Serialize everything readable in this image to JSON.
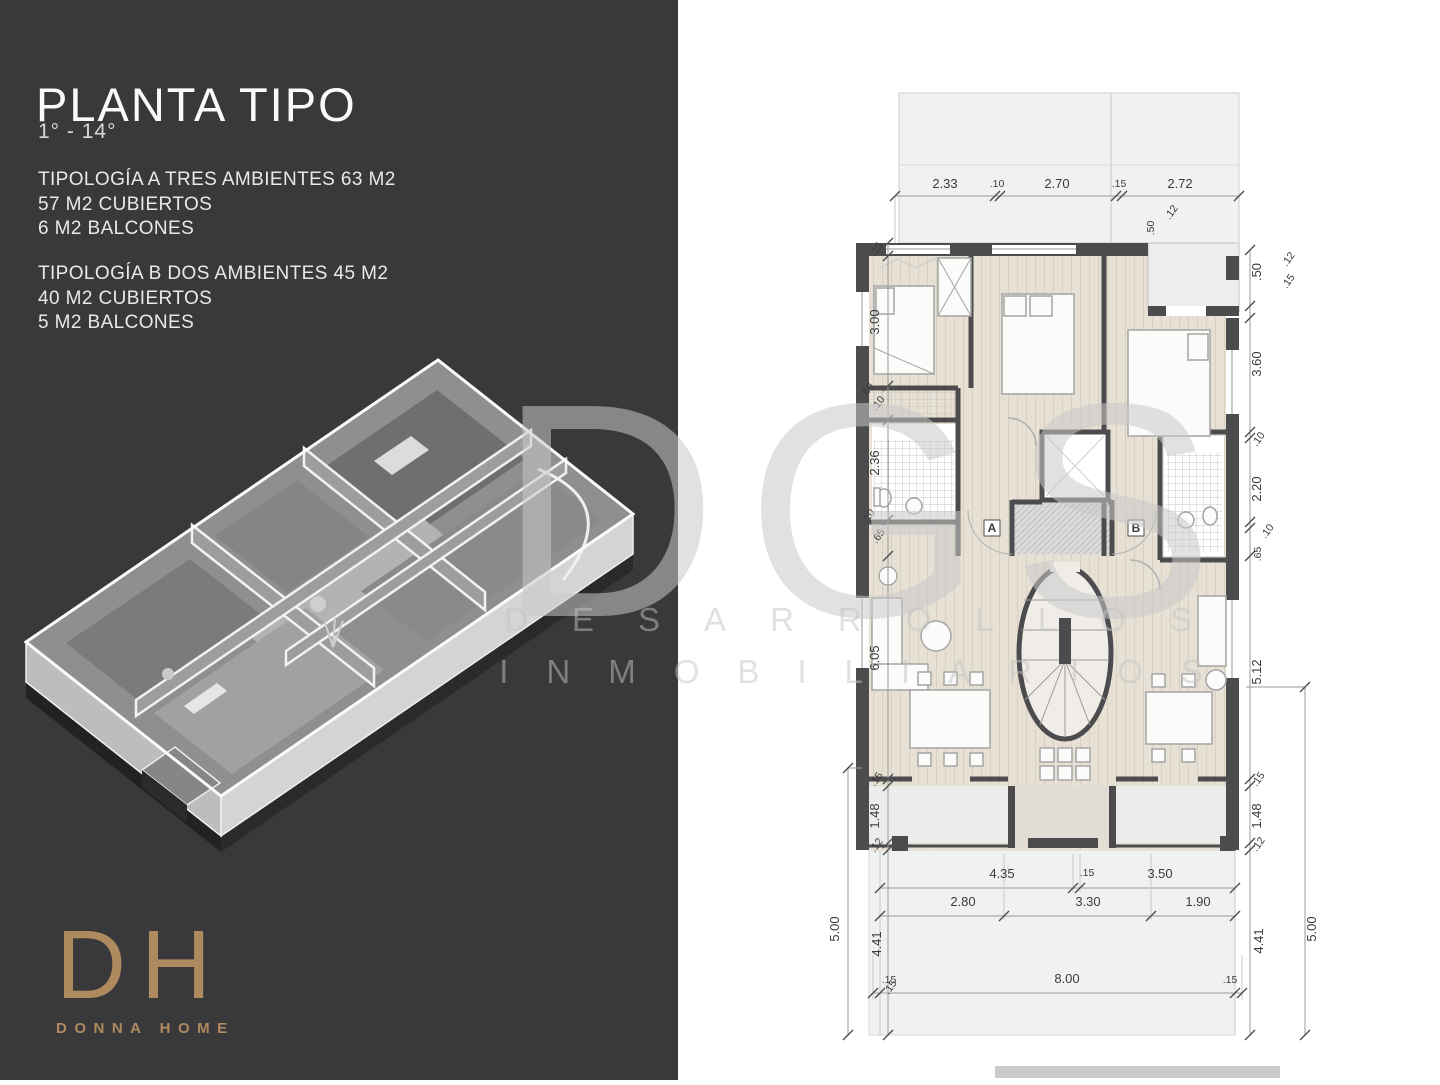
{
  "panel": {
    "title": "PLANTA TIPO",
    "floor_range": "1° - 14°",
    "typology_a": [
      "TIPOLOGÍA A TRES AMBIENTES 63 M2",
      "57 M2 CUBIERTOS",
      "6 M2 BALCONES"
    ],
    "typology_b": [
      "TIPOLOGÍA B DOS AMBIENTES 45 M2",
      "40 M2 CUBIERTOS",
      "5 M2 BALCONES"
    ],
    "logo": {
      "initials": "DH",
      "name": "DONNA HOME",
      "color": "#b08a5f"
    },
    "background_color": "#39393b"
  },
  "watermark": {
    "title": "DGS",
    "line1": "DESARROLLOS",
    "line2": "INMOBILIARIOS"
  },
  "floor_plan": {
    "unit_labels": [
      "A",
      "B"
    ],
    "wall_color": "#4c4c4e",
    "floor_color": "#e7e0d4",
    "balcony_color": "#eef0f0",
    "dims": {
      "top": [
        "2.33",
        ".10",
        "2.70",
        ".15",
        "2.72"
      ],
      "top_inner": [
        ".50",
        ".12"
      ],
      "left": [
        ".15",
        "3.00",
        ".60",
        ".10",
        "2.36",
        ".10",
        ".65",
        "6.05",
        ".15",
        "1.48",
        ".12"
      ],
      "left_outer": [
        "4.41",
        "5.00",
        ".15"
      ],
      "right": [
        ".50",
        ".15",
        ".12",
        "3.60",
        ".10",
        "2.20",
        ".10",
        ".65",
        "5.12",
        ".15",
        "1.48",
        ".12"
      ],
      "right_outer": [
        "4.41",
        "5.00"
      ],
      "bottom_upper": [
        "4.35",
        ".15",
        "3.50"
      ],
      "bottom_mid": [
        "2.80",
        "3.30",
        "1.90"
      ],
      "bottom_lower": [
        ".15",
        "8.00",
        ".15"
      ]
    }
  }
}
